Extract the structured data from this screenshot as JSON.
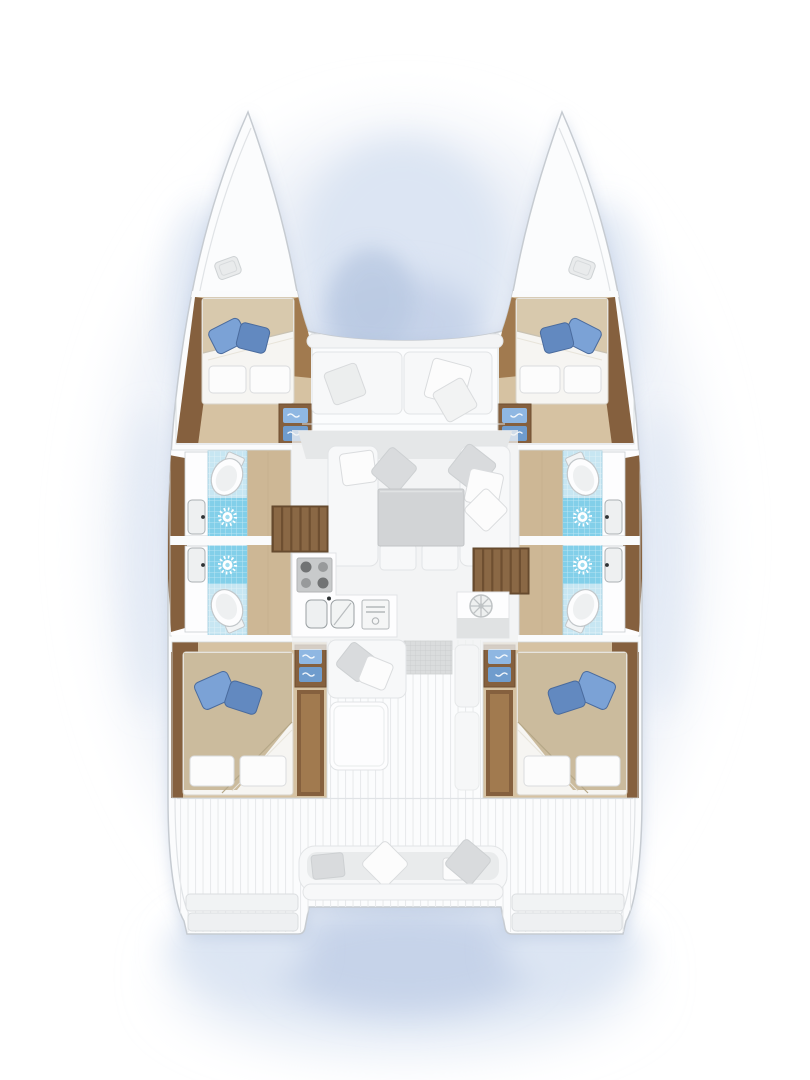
{
  "figure": {
    "type": "boat-floorplan",
    "subject": "catamaran-4-cabin-interior-layout",
    "orientation": "bow-up",
    "visible_text": []
  },
  "colors": {
    "page-bg": "#ffffff",
    "hull-fill": "#fbfcfd",
    "hull-stroke": "#c6cbd1",
    "inner-line": "#e0e3e6",
    "plank-line": "#e8eaec",
    "wall-white": "#fafbfc",
    "room-hairline": "#d3d7da",
    "wood-dark": "#85603e",
    "wood-mid": "#a17a4f",
    "wood-floor": "#d6c2a2",
    "wood-floor-2": "#cdb795",
    "stair-wood": "#6e4f31",
    "stair-bar": "#8a6845",
    "tile": "#c7e6f2",
    "shower": "#82cfe9",
    "toilet-stroke": "#c2c7ca",
    "fixture-white": "#fdfdfe",
    "fixture-gray": "#eef0f1",
    "fixture-stroke": "#c9cdd0",
    "faucet": "#2e3234",
    "pillow-blue": "#7ba2d6",
    "pillow-blue-2": "#6289c0",
    "pillow-blue-stroke": "#4a6b9d",
    "bed-white": "#f6f5f2",
    "bed-beige": "#d8c9ad",
    "bed-beige-2": "#cbbb9d",
    "bed-stroke": "#d8d4c9",
    "pillow-white": "#fcfcfc",
    "pillow-stroke": "#dadcde",
    "cushion": "#f7f8f9",
    "cushion-stroke": "#e2e4e6",
    "cushion-gray": "#e9ebec",
    "pillow-gray": "#d9dbdd",
    "sofa-band": "#e5e7e8",
    "table-gray": "#d2d4d6",
    "table-stroke": "#c2c5c7",
    "floor-salon": "#f0f1f2",
    "stove": "#c8cacb",
    "burner-dark": "#717374",
    "burner-mid": "#989a9b",
    "mat": "#dadcdd",
    "mat-line": "#c8cacc",
    "step-blue": "#8fb7e2",
    "step-blue-2": "#6f9ccd",
    "wash-soft": "#edf1f8",
    "wash-light": "#dce5f3",
    "wash-mid": "#c6d3e9",
    "wash-deep": "#b9c9e2"
  },
  "components": {
    "hulls": [
      "port",
      "starboard"
    ],
    "cabins": [
      {
        "id": "forward-port",
        "bed": "double",
        "blue_pillows": 2,
        "white_pillows": 2,
        "entry_steps": 2
      },
      {
        "id": "forward-starboard",
        "bed": "double",
        "blue_pillows": 2,
        "white_pillows": 2,
        "entry_steps": 2
      },
      {
        "id": "aft-port",
        "bed": "double",
        "blue_pillows": 2,
        "white_pillows": 2,
        "entry_steps": 2,
        "wardrobe": true
      },
      {
        "id": "aft-starboard",
        "bed": "double",
        "blue_pillows": 2,
        "white_pillows": 2,
        "entry_steps": 2,
        "wardrobe": true
      }
    ],
    "bathrooms": [
      {
        "id": "port-forward",
        "fixtures": [
          "toilet",
          "shower",
          "sink"
        ]
      },
      {
        "id": "port-aft",
        "fixtures": [
          "toilet",
          "shower",
          "sink"
        ]
      },
      {
        "id": "starboard-forward",
        "fixtures": [
          "toilet",
          "shower",
          "sink"
        ]
      },
      {
        "id": "starboard-aft",
        "fixtures": [
          "toilet",
          "shower",
          "sink"
        ]
      }
    ],
    "salon": {
      "features": [
        "forward-sofa-band",
        "u-sofa",
        "coffee-table",
        "throw-pillows"
      ]
    },
    "galley": {
      "features": [
        "stove-4-burner",
        "double-sink",
        "oven"
      ]
    },
    "nav_station": {
      "features": [
        "helm-wheel-instrument",
        "counter"
      ]
    },
    "cockpit": {
      "features": [
        "bench-with-pillows",
        "table",
        "entry-mat",
        "planked-deck"
      ]
    },
    "stern": {
      "features": [
        "transom-bench",
        "swim-steps-port",
        "swim-steps-starboard"
      ]
    },
    "foredeck": {
      "features": [
        "lounge-bench",
        "throw-pillows",
        "bow-hatch-port",
        "bow-hatch-starboard"
      ]
    }
  }
}
